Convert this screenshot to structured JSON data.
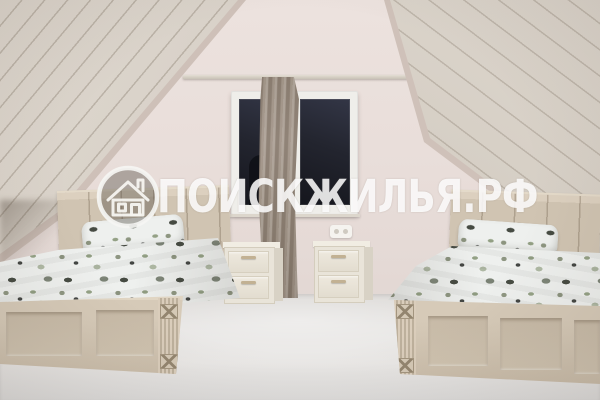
{
  "watermark": {
    "text": "ПОИСКЖИЛЬЯ.РФ",
    "icon": "house-icon",
    "text_color": "rgba(255,255,255,0.85)"
  },
  "palette": {
    "ceiling_plank": "#d8d1c8",
    "plank_seam": "#b9afa3",
    "gable_wall": "#e9deda",
    "window_glass": "#1f222c",
    "window_frame": "#efeeea",
    "curtain": "#9a8d80",
    "bed_frame": "#d0c4b2",
    "bedding_base": "#eef0ee",
    "floral_dark": "#343930",
    "floral_green": "#8a987a",
    "nightstand": "#e9e4d9",
    "floor": "#e2e0de"
  }
}
